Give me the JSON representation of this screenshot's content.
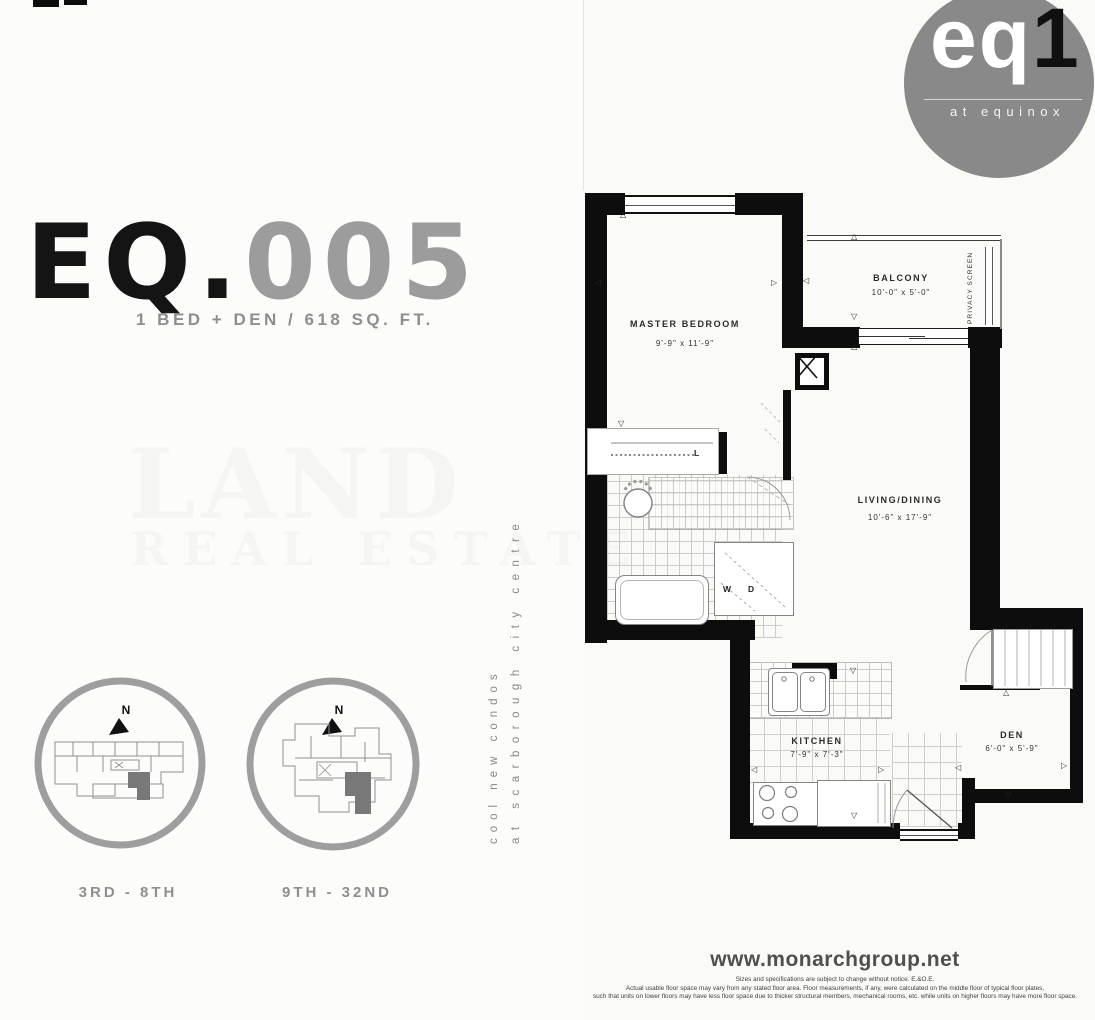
{
  "title": {
    "prefix": "EQ.",
    "number": "005",
    "subtitle": "1 BED + DEN / 618 SQ. FT."
  },
  "logo": {
    "word": "eq",
    "one": "1",
    "tagline": "at equinox",
    "circle_color": "#898989"
  },
  "watermark": {
    "line1": "LAND",
    "line2": "REAL ESTATE"
  },
  "tagline": {
    "line1": "cool new condos",
    "line2": "at scarborough city centre"
  },
  "keyplans": [
    {
      "north": "N",
      "label": "3RD - 8TH"
    },
    {
      "north": "N",
      "label": "9TH - 32ND"
    }
  ],
  "floorplan": {
    "rooms": [
      {
        "name": "MASTER BEDROOM",
        "dims": "9'-9\" x 11'-9\""
      },
      {
        "name": "BALCONY",
        "dims": "10'-0\" x 5'-0\""
      },
      {
        "name": "LIVING/DINING",
        "dims": "10'-6\" x 17'-9\""
      },
      {
        "name": "KITCHEN",
        "dims": "7'-9\" x 7'-3\""
      },
      {
        "name": "DEN",
        "dims": "6'-0\" x 5'-9\""
      }
    ],
    "labels": {
      "privacy_screen": "PRIVACY SCREEN",
      "washer": "W",
      "dryer": "D",
      "linen": "L"
    },
    "markers": {
      "up": "△",
      "down": "▽",
      "left": "◁",
      "right": "▷"
    }
  },
  "footer": {
    "website": "www.monarchgroup.net",
    "disclaimer": [
      "Sizes and specifications are subject to change without notice. E.&O.E.",
      "Actual usable floor space may vary from any stated floor area. Floor measurements, if any, were calculated on the middle floor of typical floor plates,",
      "such that units on lower floors may have less floor space due to thicker structural members, mechanical rooms, etc. while units on higher floors may have more floor space."
    ]
  },
  "colors": {
    "wall": "#0d0d0d",
    "accent_gray": "#8e8e8e",
    "highlight_unit": "#787878"
  }
}
